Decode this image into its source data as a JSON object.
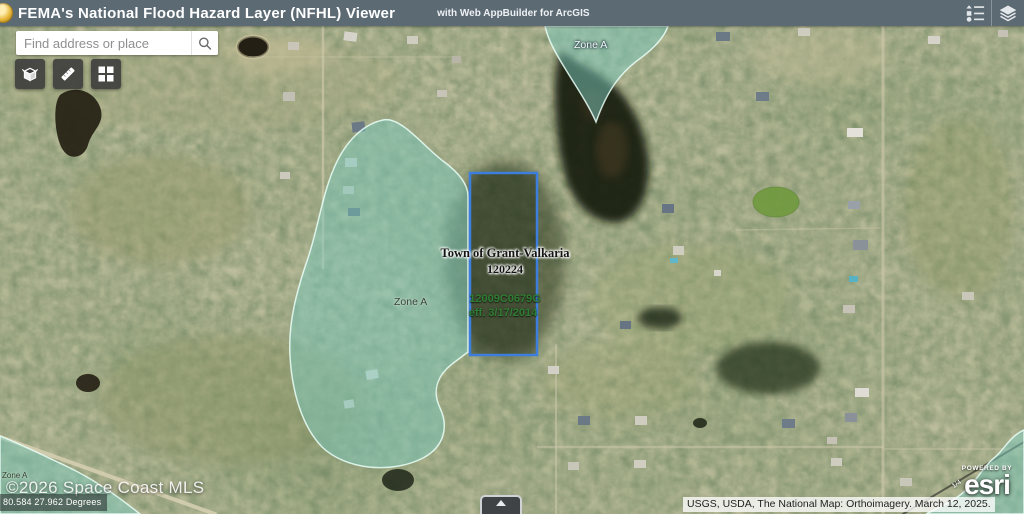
{
  "header": {
    "title": "FEMA's National Flood Hazard Layer (NFHL) Viewer",
    "subtitle": "with Web AppBuilder for ArcGIS"
  },
  "search": {
    "placeholder": "Find address or place"
  },
  "map_labels": {
    "zone_a_top": "Zone A",
    "zone_a_mid": "Zone A",
    "zone_a_corner": "Zone A",
    "town_name": "Town of Grant-Valkaria",
    "community_id": "120224",
    "firm_panel": "12009C0679G",
    "firm_effective": "eff. 3/17/2014"
  },
  "overlays": {
    "watermark": "©2026 Space Coast MLS",
    "coordinates": "80.584 27.962 Degrees",
    "attribution": "USGS, USDA, The National Map: Orthoimagery. March 12, 2025.",
    "powered_by": "POWERED BY",
    "esri_brand": "esri",
    "road_label": "1/4"
  },
  "colors": {
    "header_bg": "#5c6a74",
    "flood_zone_fill": "#7bc9bd",
    "parcel_outline": "#3d7edd"
  }
}
